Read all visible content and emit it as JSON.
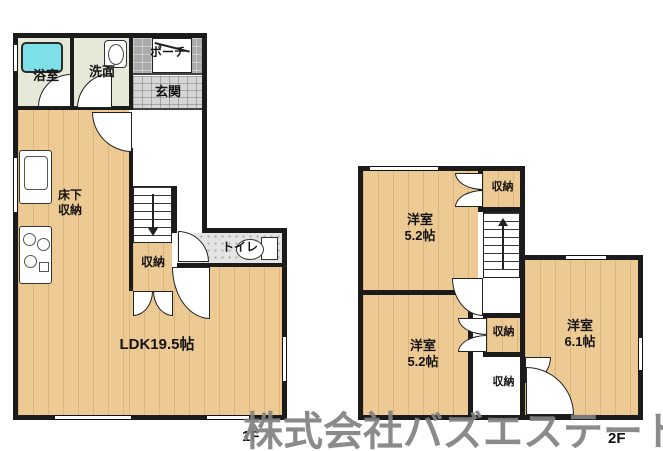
{
  "watermark_text": "株式会社バズエステート",
  "floor1": {
    "floor_label": "1F",
    "bath_label": "浴室",
    "washroom_label": "洗面",
    "porch_label": "ポーチ",
    "entrance_label": "玄関",
    "underfloor_storage_label": "床下\n収納",
    "stair_storage_label": "収納",
    "toilet_label": "トイレ",
    "ldk_label": "LDK19.5帖"
  },
  "floor2": {
    "floor_label": "2F",
    "room_nw_label": "洋室\n5.2帖",
    "closet_top_label": "収納",
    "room_sw_label": "洋室\n5.2帖",
    "closet_mid_label": "収納",
    "closet_bottom_label": "収納",
    "room_e_label": "洋室\n6.1帖"
  },
  "colors": {
    "wall": "#1b1b1b",
    "wood_floor": "#edc993",
    "bath_floor": "#e6e9d8",
    "tub": "#7ddfe8",
    "porch_floor": "#ababab",
    "entrance_floor": "#d6d6d6",
    "toilet_floor": "#e4e4e4",
    "watermark": "#828282"
  }
}
